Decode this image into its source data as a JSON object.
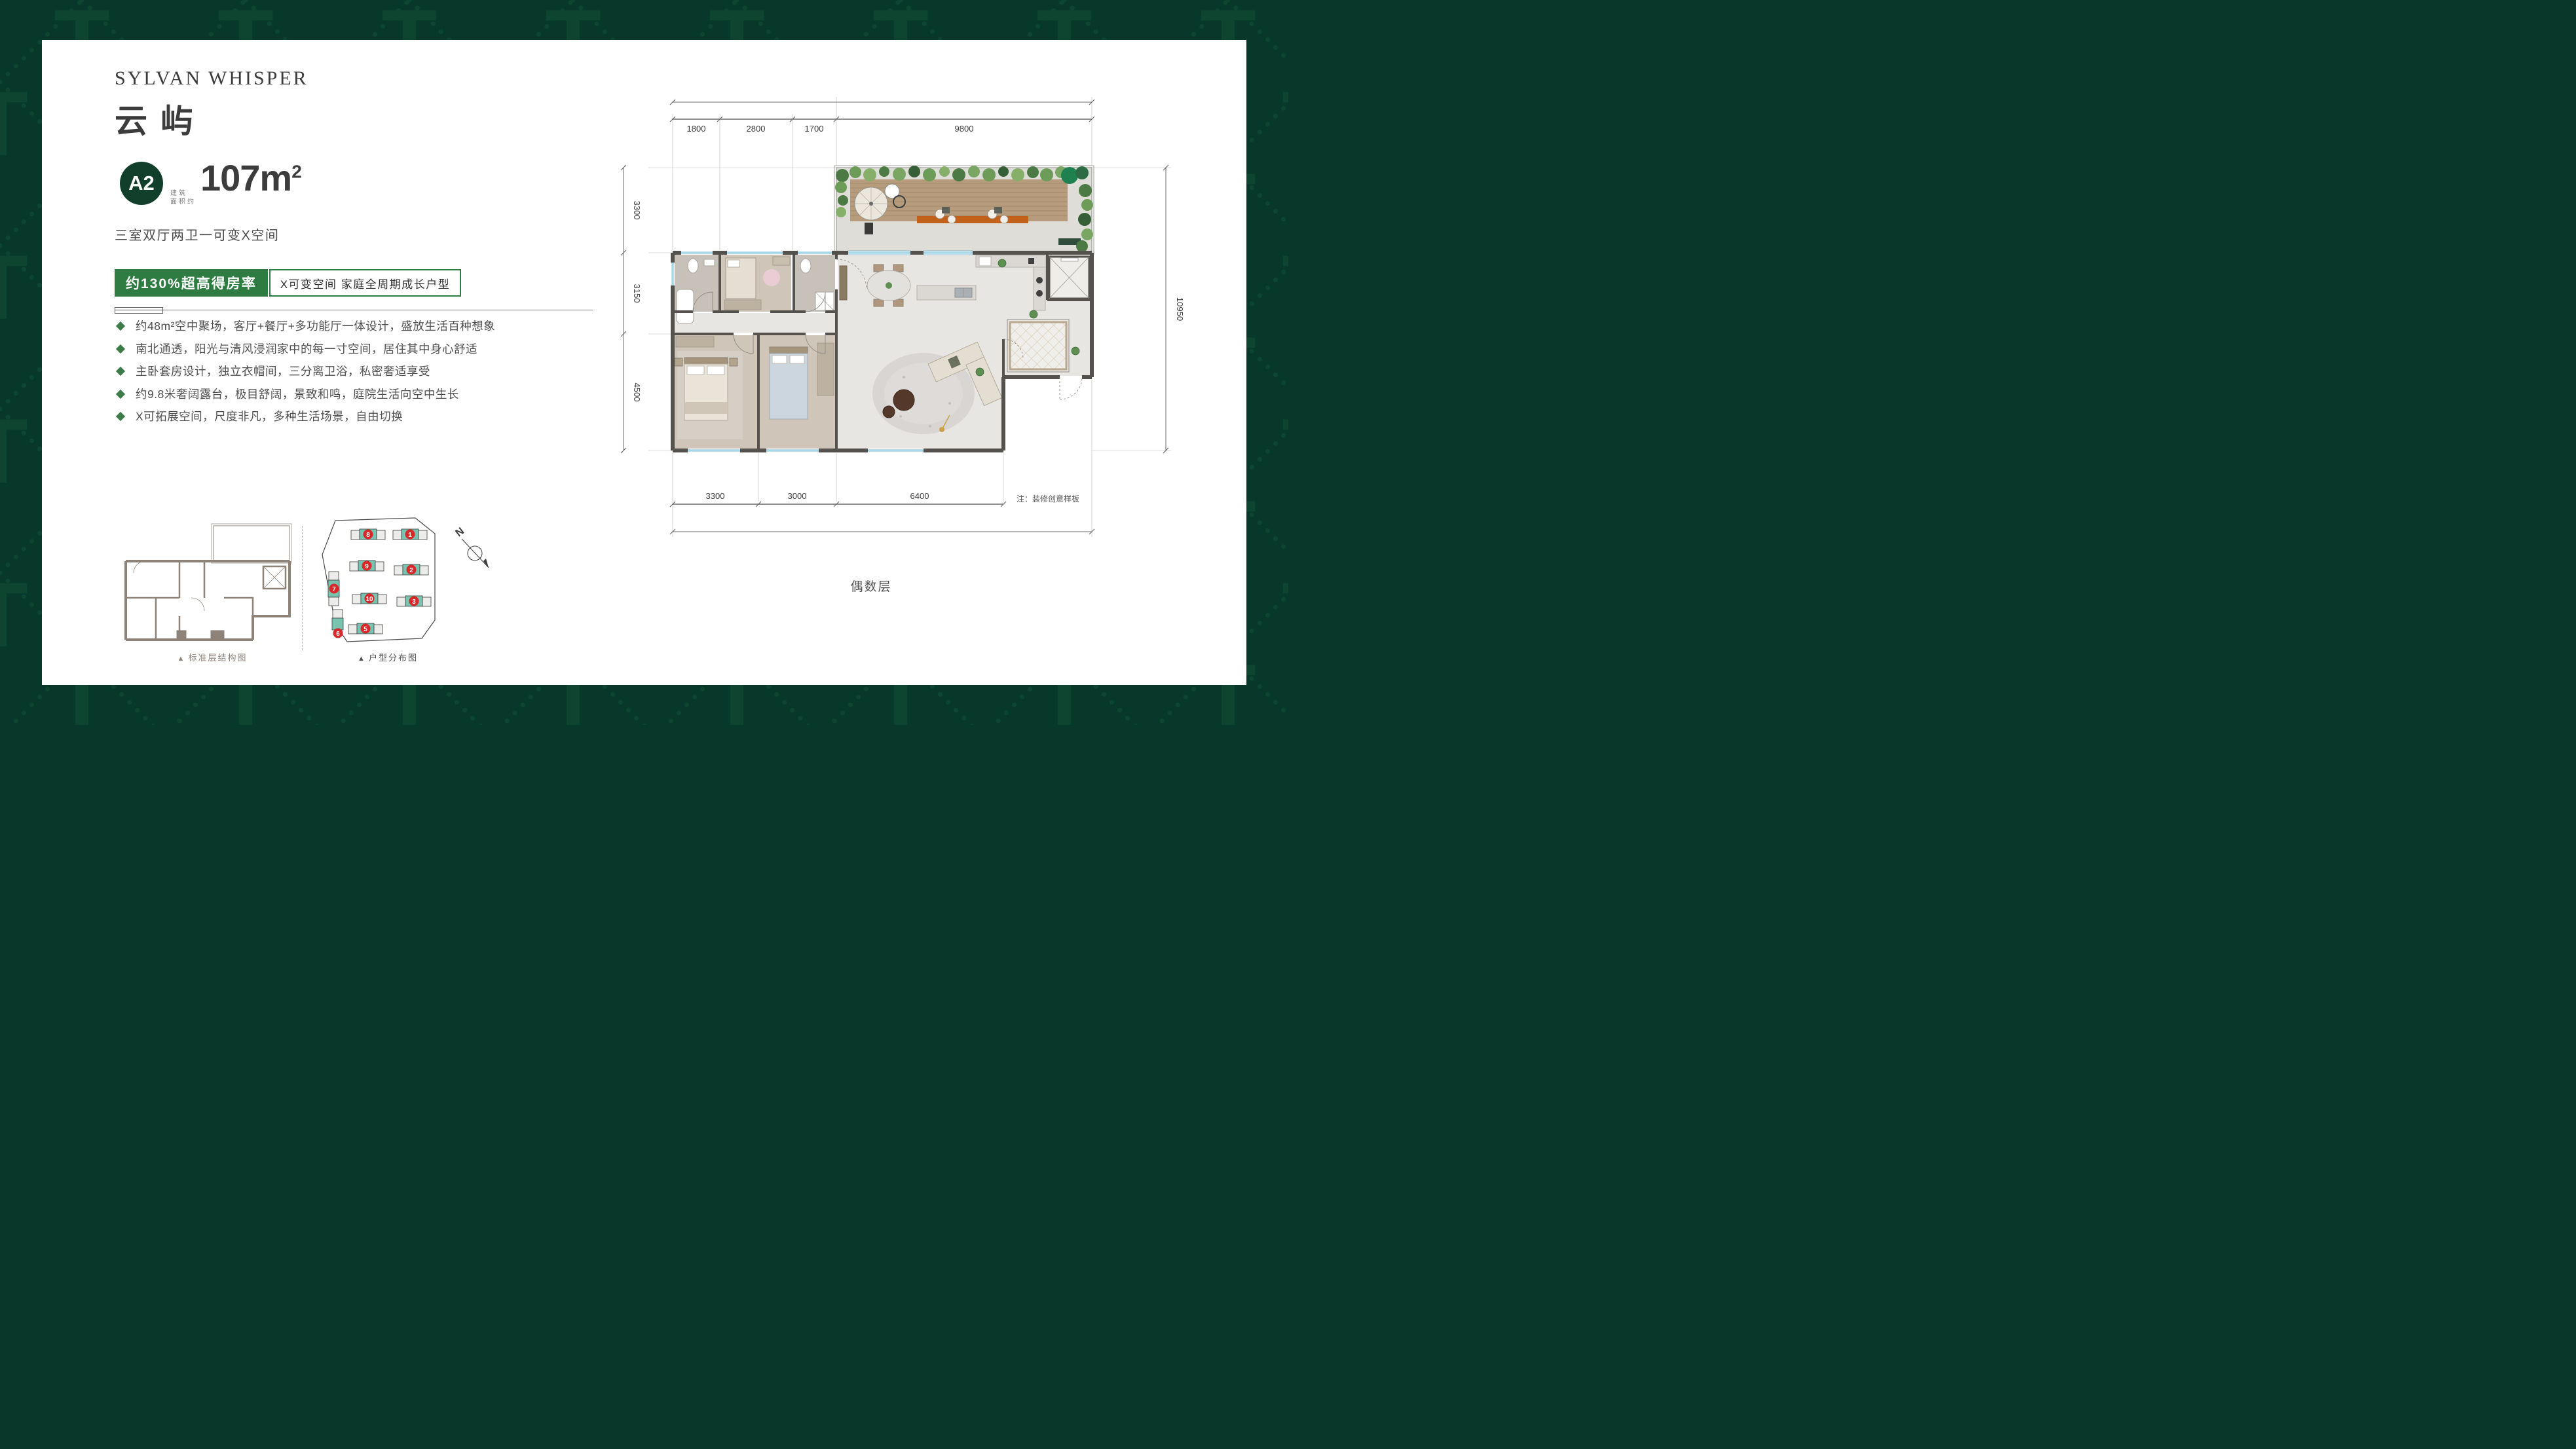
{
  "brand": {
    "title_en": "SYLVAN WHISPER",
    "title_cn": "云屿"
  },
  "unit": {
    "badge": "A2",
    "area_note_line1": "建筑",
    "area_note_line2": "面积约",
    "area_value": "107m",
    "area_sup": "2",
    "layout": "三室双厅两卫一可变X空间"
  },
  "banner": {
    "left": "约130%超高得房率",
    "right": "X可变空间 家庭全周期成长户型"
  },
  "features": [
    "约48m²空中聚场，客厅+餐厅+多功能厅一体设计，盛放生活百种想象",
    "南北通透，阳光与清风浸润家中的每一寸空间，居住其中身心舒适",
    "主卧套房设计，独立衣帽间，三分离卫浴，私密奢适享受",
    "约9.8米奢阔露台，极目舒阔，景致和鸣，庭院生活向空中生长",
    "X可拓展空间，尺度非凡，多种生活场景，自由切换"
  ],
  "floorplan": {
    "dims_top": [
      "1800",
      "2800",
      "1700",
      "9800"
    ],
    "dims_left": [
      "3300",
      "3150",
      "4500"
    ],
    "dim_right": "10950",
    "dims_bottom": [
      "3300",
      "3000",
      "6400"
    ],
    "note": "注：装修创意样板",
    "floor_label": "偶数层"
  },
  "diagrams": {
    "marker": "▲",
    "structure_caption": "标准层结构图",
    "distribution_caption": "户型分布图",
    "compass_label": "N",
    "building_numbers": [
      "8",
      "1",
      "9",
      "2",
      "10",
      "3",
      "7",
      "6",
      "5"
    ]
  },
  "colors": {
    "frame_green": "#07382a",
    "pattern_green": "#0d4531",
    "accent_green": "#2e7c42",
    "badge_green": "#123f2c",
    "teal": "#79c3b1",
    "badge_red": "#d7282a",
    "wall_gray": "#55524e"
  }
}
